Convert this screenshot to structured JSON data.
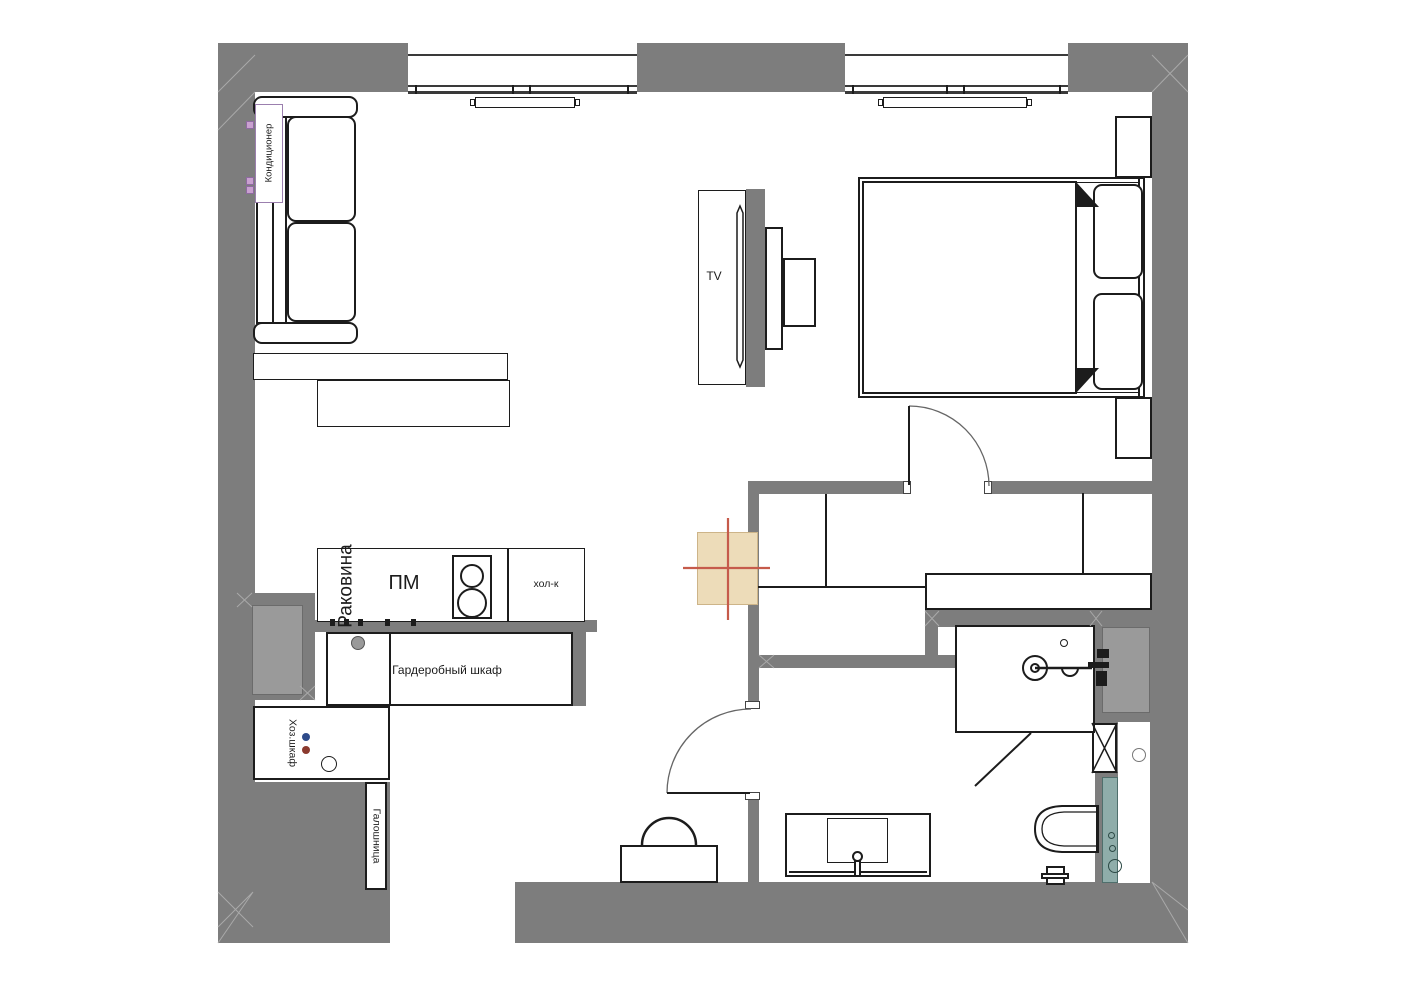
{
  "drawing": {
    "kind": "apartment floor plan",
    "units": "none shown"
  },
  "colors": {
    "wall": "#7d7d7d",
    "outline": "#1c1c1c",
    "duct": "#9a9a9a",
    "hatch": "#a9a9a9",
    "vent_shaft_fill": "#eddcb9",
    "vent_shaft_border": "#cdb488",
    "axis_cross": "#c65b4b",
    "towel_rail": "#8fadaa",
    "towel_rail_border": "#4f6f6c",
    "ac_border": "#9b7fae",
    "ac_socket": "#c9a0d0",
    "dot_blue": "#2e4b8a",
    "dot_red": "#8b3a2e"
  },
  "labels": {
    "air_conditioner": "Кондиционер",
    "tv": "TV",
    "sink": "Раковина",
    "dishwasher": "ПМ",
    "fridge": "хол-к",
    "wardrobe_closet": "Гардеробный шкаф",
    "utility_closet": "Хоз.шкаф",
    "shoe_cabinet": "Галошница"
  }
}
